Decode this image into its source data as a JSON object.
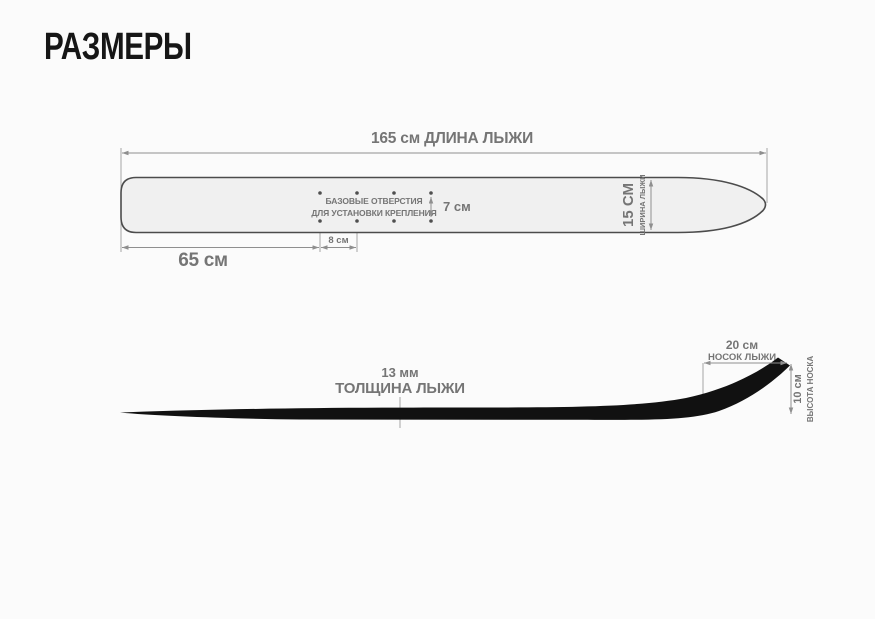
{
  "title": "РАЗМЕРЫ",
  "colors": {
    "background": "#fbfbfb",
    "title_ink": "#161616",
    "dimension_lines": "#8f8f8f",
    "dimension_text": "#757575",
    "ski_top_fill": "#f0f0f0",
    "ski_top_outline": "#4c4c4c",
    "ski_profile_fill": "#111111"
  },
  "top_view": {
    "length_label": "165 см  ДЛИНА ЛЫЖИ",
    "tail_to_holes_label": "65 см",
    "hole_spacing_label": "8 см",
    "hole_rows_gap_label": "7 см",
    "holes_note_line1": "БАЗОВЫЕ ОТВЕРСТИЯ",
    "holes_note_line2": "ДЛЯ УСТАНОВКИ КРЕПЛЕНИЯ",
    "width_value": "15 СМ",
    "width_label": "ШИРИНА ЛЫЖИ"
  },
  "side_view": {
    "thickness_value": "13 мм",
    "thickness_label": "ТОЛЩИНА ЛЫЖИ",
    "tip_length_value": "20 см",
    "tip_length_label": "НОСОК ЛЫЖИ",
    "tip_height_value": "10 см",
    "tip_height_label": "ВЫСОТА НОСКА"
  }
}
